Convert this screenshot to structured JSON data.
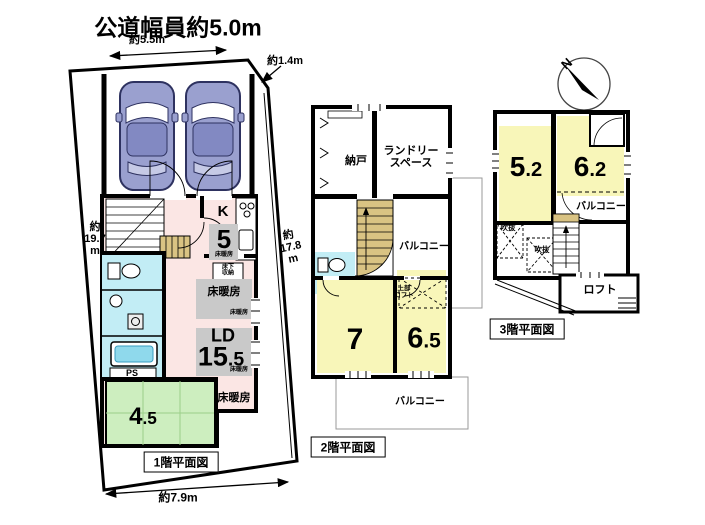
{
  "site": {
    "title": "公道幅員約5.0m",
    "dim_top": "約5.5m",
    "dim_corner": "約1.4m",
    "dim_left": "約\n19.7\nm",
    "dim_right": "約\n17.8\nm",
    "dim_bottom": "約7.9m"
  },
  "floor1": {
    "caption": "1階平面図",
    "kitchen_k": "K",
    "kitchen_size": "5",
    "kitchen_floor_heating": "床暖房",
    "underfloor_storage": "床下\n収納",
    "floor_heating_panel": "床暖房",
    "floor_heating_small_1": "床暖房",
    "ld": "LD",
    "ld_size_int": "15",
    "ld_size_dec": ".5",
    "floor_heating_small_2": "床暖房",
    "floor_heating_bold": "床暖房",
    "ps": "PS",
    "tatami_size_int": "4",
    "tatami_size_dec": ".5"
  },
  "floor2": {
    "caption": "2階平面図",
    "storage_room": "納戸",
    "laundry_space": "ランドリー\nスペース",
    "balcony_mid": "バルコニー",
    "upper_loft": "上部\nロフト",
    "room7_size": "7",
    "room65_int": "6",
    "room65_dec": ".5",
    "balcony_bottom": "バルコニー"
  },
  "floor3": {
    "caption": "3階平面図",
    "room52_int": "5",
    "room52_dec": ".2",
    "room62_int": "6",
    "room62_dec": ".2",
    "balcony": "バルコニー",
    "void_1": "吹抜",
    "void_2": "吹抜",
    "loft": "ロフト",
    "compass_north": "N"
  },
  "colors": {
    "room_pink": "#fbe6e4",
    "room_yellow": "#f8f6b9",
    "room_green": "#cdeebf",
    "wet_cyan": "#c2edf5",
    "stair_tan": "#d9c383",
    "heat_gray": "#c9c9c9",
    "car_blue": "#9aa0cf"
  }
}
